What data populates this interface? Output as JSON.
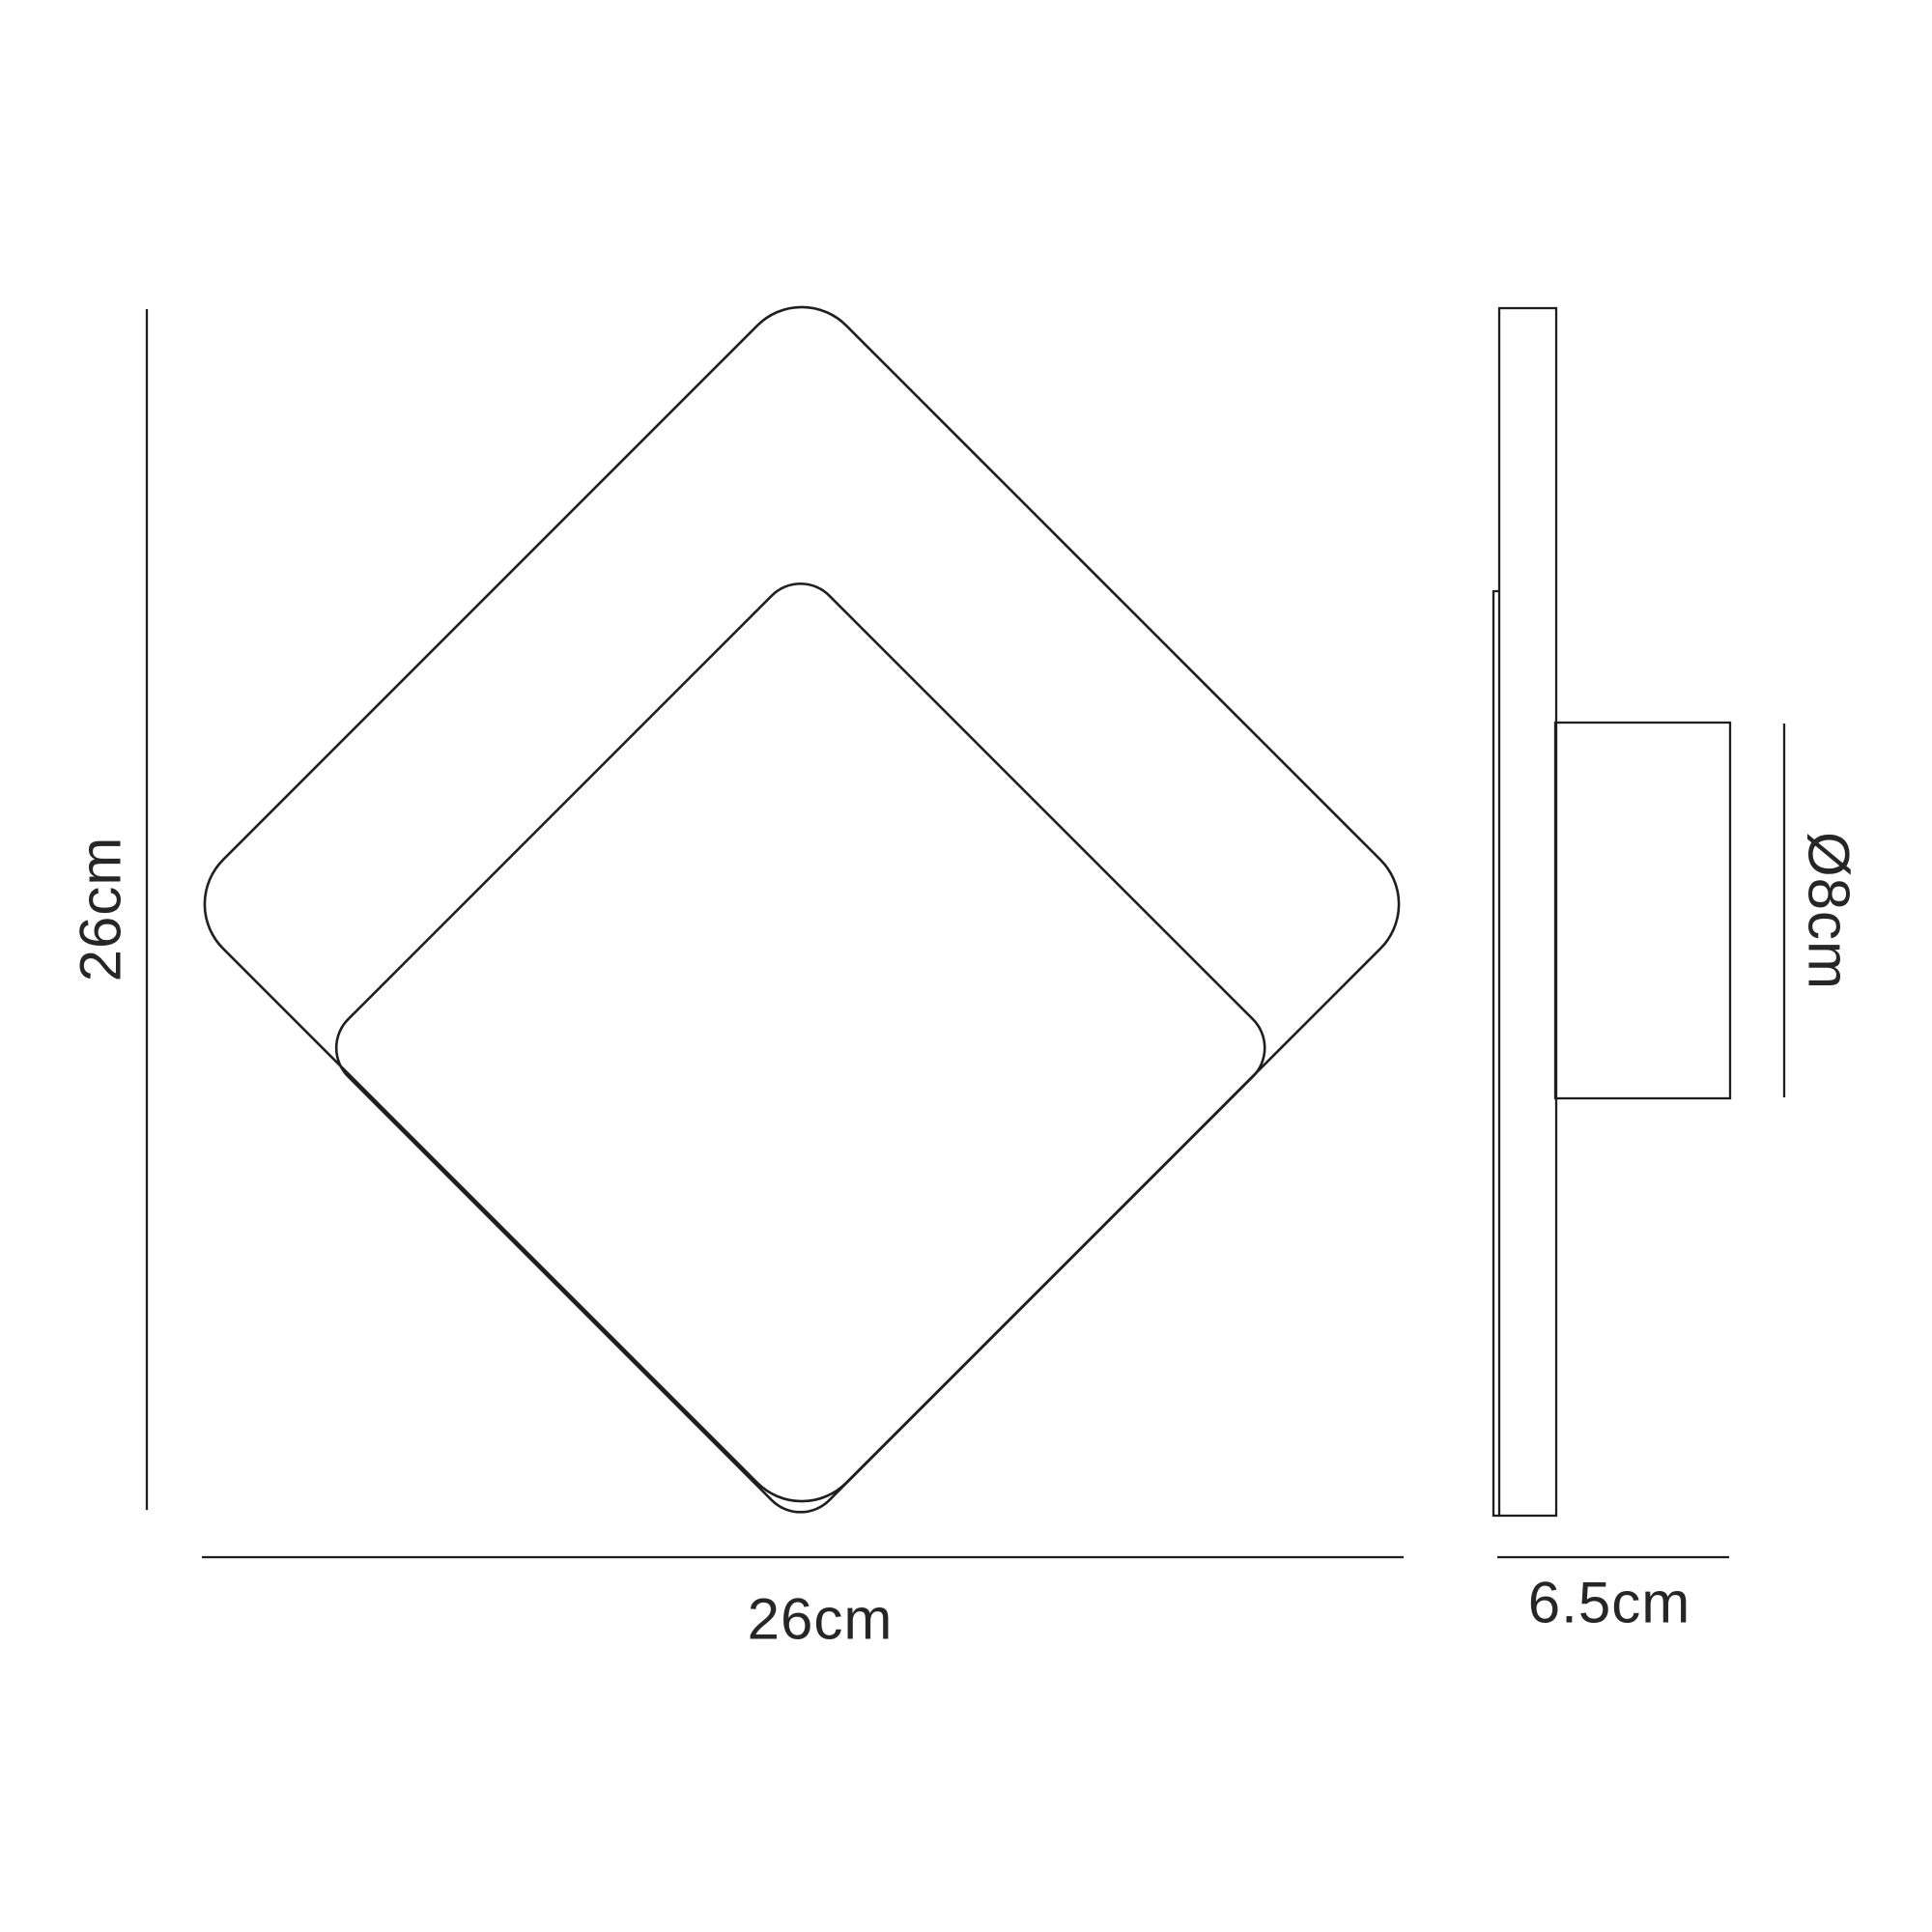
{
  "diagram_title": "wall-light-dimension-diagram",
  "front_view": {
    "height_label": "26cm",
    "width_label": "26cm"
  },
  "side_view": {
    "depth_label": "6.5cm",
    "diameter_label": "Ø8cm"
  },
  "colors": {
    "line": "#1f1f1f",
    "text": "#262626",
    "background": "#ffffff"
  }
}
